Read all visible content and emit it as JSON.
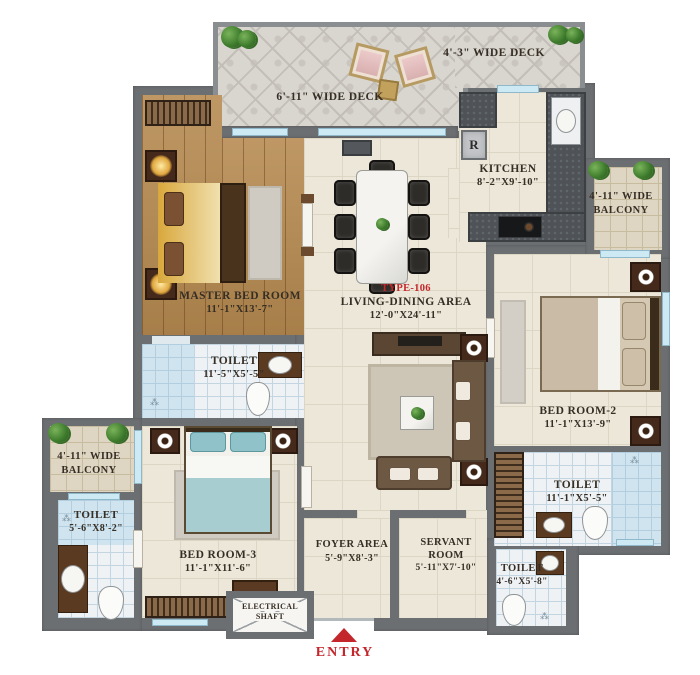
{
  "title": "Apartment Floor Plan",
  "type_label": "TYPE-106",
  "entry_label": "ENTRY",
  "kitchen_appliance_label": "R",
  "rooms": {
    "master_bedroom": {
      "name": "MASTER BED ROOM",
      "dims": "11'-1\"X13'-7\""
    },
    "living_dining": {
      "name": "LIVING-DINING AREA",
      "dims": "12'-0\"X24'-11\""
    },
    "kitchen": {
      "name": "KITCHEN",
      "dims": "8'-2\"X9'-10\""
    },
    "bedroom_2": {
      "name": "BED ROOM-2",
      "dims": "11'-1\"X13'-9\""
    },
    "bedroom_3": {
      "name": "BED ROOM-3",
      "dims": "11'-1\"X11'-6\""
    },
    "toilet_master": {
      "name": "TOILET",
      "dims": "11'-5\"X5'-5\""
    },
    "toilet_left": {
      "name": "TOILET",
      "dims": "5'-6\"X8'-2\""
    },
    "toilet_bedroom_2": {
      "name": "TOILET",
      "dims": "11'-1\"X5'-5\""
    },
    "toilet_servant": {
      "name": "TOILET",
      "dims": "4'-6\"X5'-8\""
    },
    "foyer": {
      "name": "FOYER AREA",
      "dims": "5'-9\"X8'-3\""
    },
    "servant_room": {
      "line1": "SERVANT",
      "line2": "ROOM",
      "dims": "5'-11\"X7'-10\""
    },
    "deck_top": {
      "name": "6'-11\" WIDE DECK"
    },
    "deck_right": {
      "name": "4'-3\" WIDE DECK"
    },
    "balcony_right": {
      "line1": "4'-11\" WIDE",
      "line2": "BALCONY"
    },
    "balcony_left": {
      "line1": "4'-11\" WIDE",
      "line2": "BALCONY"
    },
    "electrical_shaft": {
      "line1": "ELECTRICAL",
      "line2": "SHAFT"
    }
  },
  "colors": {
    "wall": "#6c6f72",
    "accent_red": "#c3262b",
    "wood_floor": "#b5894f",
    "tile_floor": "#ece7d9",
    "bath_tile": "#eef2f5",
    "shower_tile": "#cfe4ef",
    "deck_tile": "#d9d6d0",
    "balcony_tile": "#ded5c2",
    "label_text": "#362e25"
  }
}
